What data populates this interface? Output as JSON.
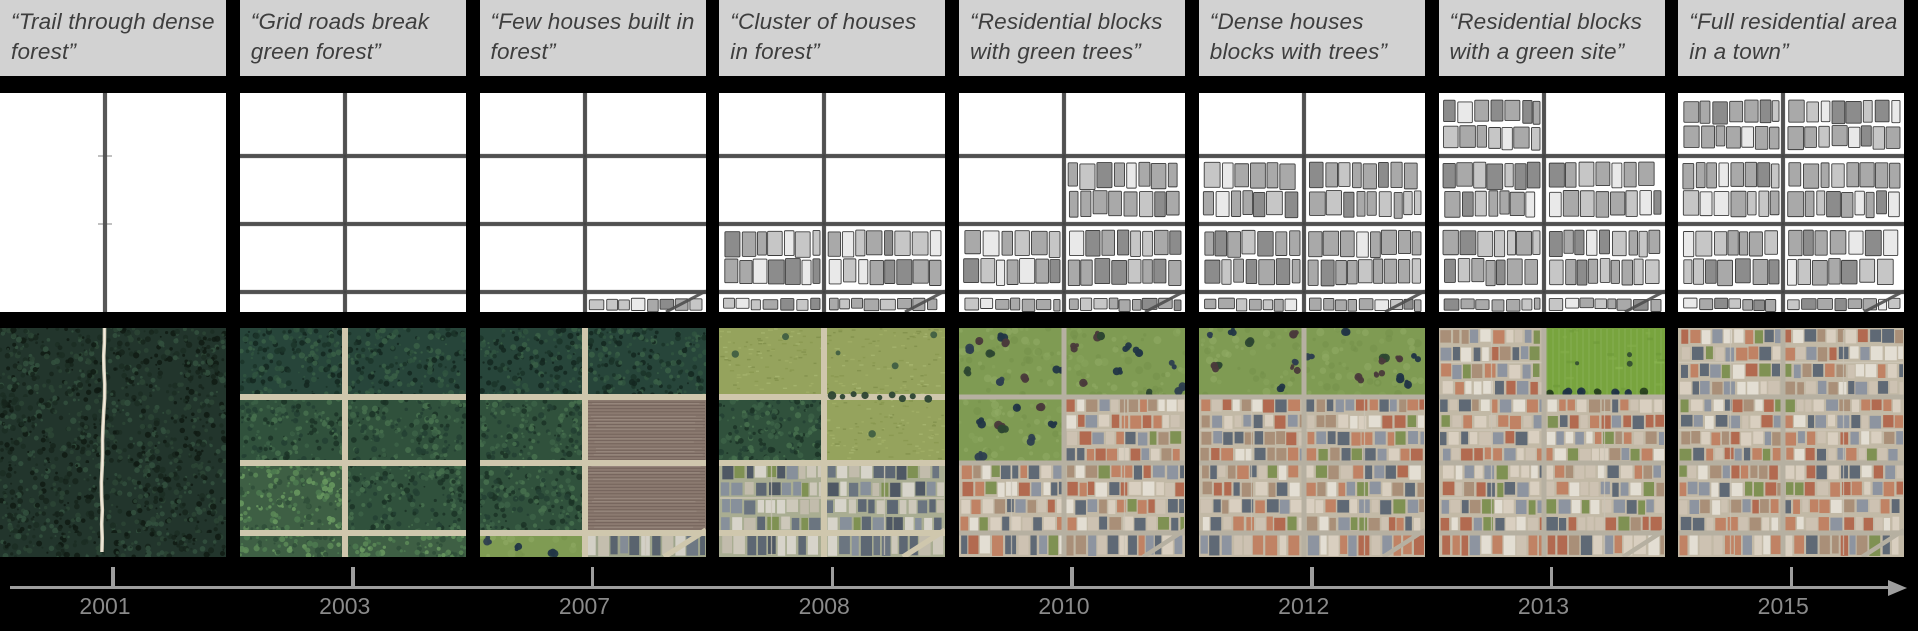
{
  "figure": {
    "description_visible_text_only": true,
    "columns": [
      {
        "year": "2001",
        "caption": "“Trail through dense forest”",
        "map": {
          "vertical_road": true,
          "horizontal_roads": false,
          "diagonal_road": false,
          "house_regions": []
        },
        "sat": {
          "type": "trail",
          "roads": null,
          "diagonal_road": false,
          "regions": {
            "b0l": "forest_darkest",
            "b0r": "forest_darkest",
            "b1l": "forest_darkest",
            "b1r": "forest_darkest",
            "b2l": "forest_darkest",
            "b2r": "forest_darkest",
            "sl": "forest_darkest",
            "sr": "forest_darkest"
          }
        }
      },
      {
        "year": "2003",
        "caption": "“Grid roads break green forest”",
        "map": {
          "vertical_road": true,
          "horizontal_roads": true,
          "diagonal_road": false,
          "house_regions": []
        },
        "sat": {
          "type": "grid",
          "roads": "tan",
          "diagonal_road": false,
          "regions": {
            "b0l": "forest_dark",
            "b0r": "forest_dark",
            "b1l": "forest",
            "b1r": "forest",
            "b2l": "forest_light",
            "b2r": "forest",
            "sl": "forest_light",
            "sr": "forest_light"
          }
        }
      },
      {
        "year": "2007",
        "caption": "“Few houses built in forest”",
        "map": {
          "vertical_road": true,
          "horizontal_roads": true,
          "diagonal_road": true,
          "house_regions": [
            "sr"
          ]
        },
        "sat": {
          "type": "grid",
          "roads": "tan",
          "diagonal_road": true,
          "regions": {
            "b0l": "forest_dark",
            "b0r": "forest_dark",
            "b1l": "forest",
            "b1r": "tilled",
            "b2l": "forest",
            "b2r": "tilled",
            "sl": "grass_trees",
            "sr": "houses_small"
          }
        }
      },
      {
        "year": "2008",
        "caption": "“Cluster of houses in forest”",
        "map": {
          "vertical_road": true,
          "horizontal_roads": true,
          "diagonal_road": true,
          "house_regions": [
            "b2l",
            "b2r",
            "sl",
            "sr"
          ]
        },
        "sat": {
          "type": "grid",
          "roads": "tan",
          "diagonal_road": true,
          "treeline": true,
          "regions": {
            "b0l": "field_olive",
            "b0r": "field_olive",
            "b1l": "forest",
            "b1r": "field_olive",
            "b2l": "houses_slate",
            "b2r": "houses_slate",
            "sl": "houses_slate",
            "sr": "houses_slate"
          }
        }
      },
      {
        "year": "2010",
        "caption": "“Residential blocks with green trees”",
        "map": {
          "vertical_road": true,
          "horizontal_roads": true,
          "diagonal_road": true,
          "house_regions": [
            "b1r",
            "b2l",
            "b2r",
            "sl",
            "sr"
          ]
        },
        "sat": {
          "type": "grid",
          "roads": "gray",
          "diagonal_road": true,
          "regions": {
            "b0l": "grass_trees",
            "b0r": "grass_trees",
            "b1l": "grass_trees",
            "b1r": "houses_warm",
            "b2l": "houses_warm",
            "b2r": "houses_warm",
            "sl": "houses_warm",
            "sr": "houses_warm"
          }
        }
      },
      {
        "year": "2012",
        "caption": "“Dense houses blocks with trees”",
        "map": {
          "vertical_road": true,
          "horizontal_roads": true,
          "diagonal_road": true,
          "house_regions": [
            "b1l",
            "b1r",
            "b2l",
            "b2r",
            "sl",
            "sr"
          ]
        },
        "sat": {
          "type": "grid",
          "roads": "gray",
          "diagonal_road": true,
          "regions": {
            "b0l": "grass_trees",
            "b0r": "grass_trees",
            "b1l": "houses_warm",
            "b1r": "houses_warm",
            "b2l": "houses_warm",
            "b2r": "houses_warm",
            "sl": "houses_warm",
            "sr": "houses_warm"
          }
        }
      },
      {
        "year": "2013",
        "caption": "“Residential blocks with a green site”",
        "map": {
          "vertical_road": true,
          "horizontal_roads": true,
          "diagonal_road": true,
          "house_regions": [
            "b0l",
            "b1l",
            "b1r",
            "b2l",
            "b2r",
            "sl",
            "sr"
          ]
        },
        "sat": {
          "type": "grid",
          "roads": "gray",
          "diagonal_road": true,
          "regions": {
            "b0l": "houses_warm",
            "b0r": "green_field",
            "b1l": "houses_warm",
            "b1r": "houses_warm",
            "b2l": "houses_warm",
            "b2r": "houses_warm",
            "sl": "houses_warm",
            "sr": "houses_warm"
          }
        }
      },
      {
        "year": "2015",
        "caption": "“Full residential area in a town”",
        "map": {
          "vertical_road": true,
          "horizontal_roads": true,
          "diagonal_road": true,
          "house_regions": [
            "b0l",
            "b0r",
            "b1l",
            "b1r",
            "b2l",
            "b2r",
            "sl",
            "sr"
          ]
        },
        "sat": {
          "type": "grid",
          "roads": "gray",
          "diagonal_road": true,
          "regions": {
            "b0l": "houses_warm",
            "b0r": "houses_warm",
            "b1l": "houses_warm",
            "b1r": "houses_warm",
            "b2l": "houses_warm",
            "b2r": "houses_warm",
            "sl": "houses_warm",
            "sr": "houses_warm"
          }
        }
      }
    ],
    "timeline": {
      "years": [
        "2001",
        "2003",
        "2007",
        "2008",
        "2010",
        "2012",
        "2013",
        "2015"
      ],
      "arrow": "right"
    }
  },
  "colors": {
    "background": "#000000",
    "caption_bg": "#d2d2d2",
    "caption_text": "#3e3e3e",
    "axis_line": "#9e9e9e",
    "axis_tick": "#9e9e9e",
    "year_label": "#8a8a8a",
    "map_bg": "#ffffff",
    "map_road": "#4f4f4f",
    "map_house_fills": [
      "#a9a9a9",
      "#c6c6c6",
      "#8c8c8c",
      "#e9e9e9"
    ],
    "map_house_stroke": "#3d3d3d",
    "sat_road_tan": "#cfc7ad",
    "sat_road_gray": "#b6b0a1",
    "trail": "#d9d0bc",
    "terrains": {
      "forest_darkest": {
        "base": "#22352c",
        "accents": [
          "#16251c",
          "#2b4435",
          "#1b2d23",
          "#33503e",
          "#0f1a13"
        ]
      },
      "forest_dark": {
        "base": "#27453a",
        "accents": [
          "#1b3429",
          "#30543f",
          "#3a5f46",
          "#142720"
        ]
      },
      "forest": {
        "base": "#30513c",
        "accents": [
          "#234032",
          "#3c6146",
          "#47704d",
          "#1b3226"
        ]
      },
      "forest_light": {
        "base": "#3e5f44",
        "accents": [
          "#4d7a50",
          "#5c8a57",
          "#2f4d38",
          "#6a9a60"
        ]
      },
      "tilled": {
        "base": "#8b7a70",
        "accents": [
          "#7a695f",
          "#9c8b80",
          "#6b5c54",
          "#a89888"
        ]
      },
      "field_olive": {
        "base": "#95a35d",
        "accents": [
          "#a4b169",
          "#87954f",
          "#aab873",
          "#7e8c48"
        ]
      },
      "grass_trees": {
        "base": "#7f9b53",
        "accents": [
          "#8aa65e",
          "#74904a",
          "#93ad68"
        ],
        "trees": [
          "#2e3f4f",
          "#2d4732",
          "#4a3a3b",
          "#223646"
        ]
      },
      "green_field": {
        "base": "#78a43e",
        "accents": [
          "#86b04b",
          "#6a9636",
          "#8fbc55"
        ],
        "trees": [
          "#27401f",
          "#203346"
        ]
      },
      "houses_small": {
        "ground": "#9fa58c",
        "palette": [
          "#6e7883",
          "#d3d0c6",
          "#59636e",
          "#c4beae",
          "#848c96"
        ]
      },
      "houses_slate": {
        "ground": "#a9ad92",
        "palette": [
          "#5d6773",
          "#6b7580",
          "#d7d4ca",
          "#c2bcac",
          "#87909b",
          "#4f5864",
          "#cdc8ba"
        ]
      },
      "houses_warm": {
        "ground": "#c2b9a6",
        "palette": [
          "#d9cfc0",
          "#c08264",
          "#5f6975",
          "#cdc2b2",
          "#b26a50",
          "#8d94a0",
          "#e3ded3",
          "#a98f78"
        ]
      },
      "green_patch": "#7f9153"
    }
  }
}
